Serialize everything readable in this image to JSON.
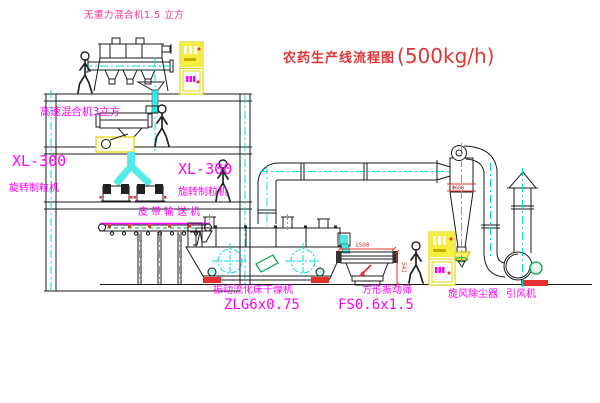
{
  "diagram": {
    "title_cn": "农药生产线流程图",
    "title_capacity": "(500kg/h)"
  },
  "equipment": {
    "gravity_mixer": "无重力混合机1.5 立方",
    "high_speed_mixer": "高速混合机3立方",
    "granulator_left": {
      "model": "XL-300",
      "name": "旋转制粒机"
    },
    "granulator_right": {
      "model": "XL-300",
      "name": "旋转制粒机"
    },
    "belt_conveyor": "皮带输送机",
    "fluid_bed_dryer": {
      "name": "振动流化床干燥机",
      "model": "ZLG6x0.75"
    },
    "square_sieve": {
      "name": "方形振动筛",
      "model": "FS0.6x1.5"
    },
    "cyclone": "旋风除尘器",
    "induced_draft_fan": "引风机"
  },
  "dimensions": {
    "sieve_length": "1500",
    "sieve_height": "541",
    "cyclone_marking": "Φ600"
  },
  "colors": {
    "label_magenta": "#ff00ff",
    "title_red": "#e03535",
    "pink_label": "#f23399",
    "pipe_cyan": "#00d9d9",
    "cabinet_yellow": "#f6ee3e",
    "alert_red": "#e53030",
    "motor_green": "#00a550"
  }
}
